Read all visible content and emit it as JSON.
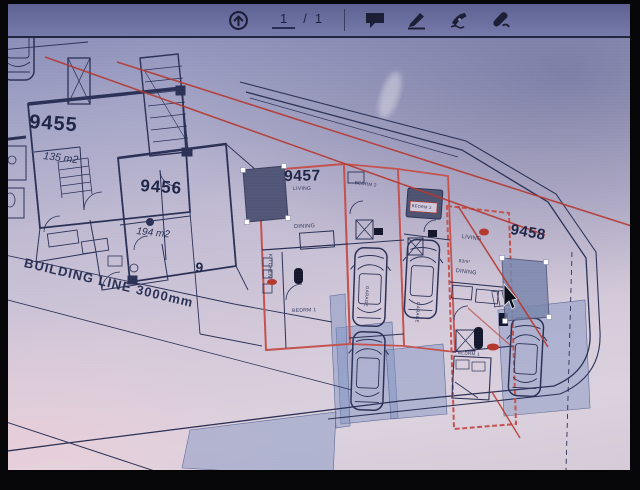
{
  "toolbar": {
    "page_current": "1",
    "page_separator": "/",
    "page_total": "1"
  },
  "plan": {
    "units": {
      "u9455": {
        "number": "9455",
        "area": "135 m2"
      },
      "u9456": {
        "number": "9456",
        "area": "194 m2"
      },
      "u9457": {
        "number": "9457"
      },
      "u9458": {
        "number": "9458"
      }
    },
    "building_line": "BUILDING LINE 3000mm",
    "erf_number": "9",
    "rooms": {
      "living_a": "LIVING",
      "dining_a": "DINING",
      "kitchen_a": "KITCHEN",
      "bedrm1_a": "BEDRM 1",
      "bedrm2_a": "BEDRM 2",
      "bedrm2_b": "BEDRM 2",
      "garage_a": "GARAGE",
      "garage_b": "GARAGE",
      "living_b": "LIVING",
      "area_b": "83m²",
      "dining_b": "DINING",
      "bedrm1_b": "BEDRM 1"
    }
  },
  "colors": {
    "red_ink": "#b5382f",
    "plan_ink": "#2b3156",
    "unit_outline": "#c4524e",
    "selection_fill": "#515577",
    "toolbar_icon": "#1c1f36"
  }
}
